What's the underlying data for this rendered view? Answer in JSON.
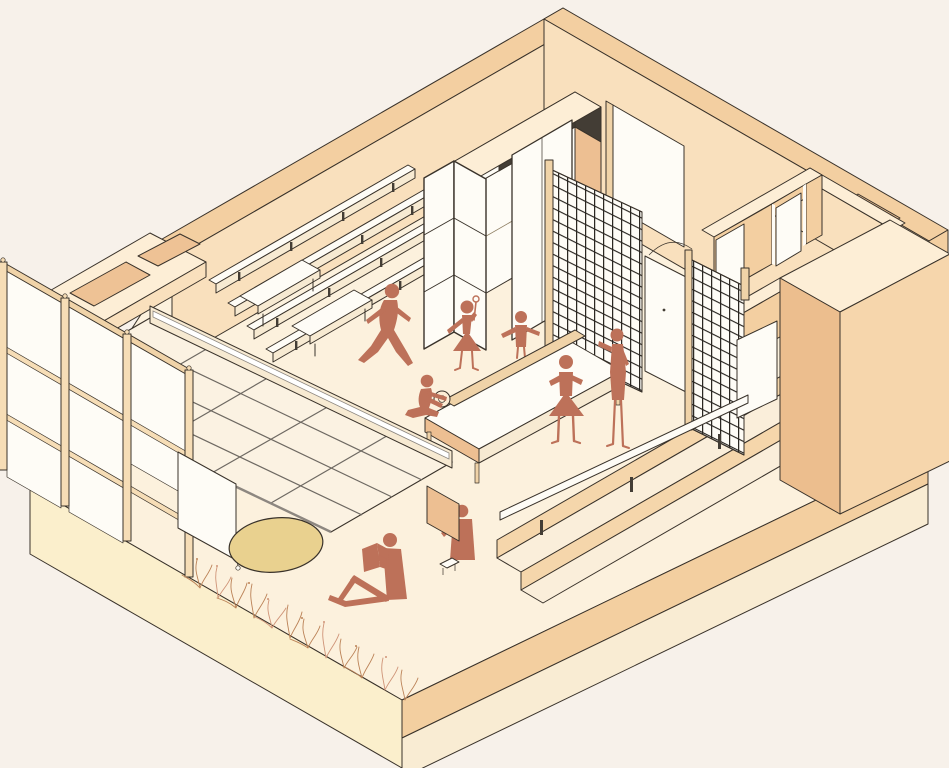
{
  "meta": {
    "image_type": "axonometric cutaway illustration",
    "subject": "open-plan interior (library / community room) with skylight, tiered wall shelving, wire-mesh partitions, long reading table and human silhouettes",
    "figure_count": 8
  },
  "palette": {
    "bg": "#f7f1ea",
    "line": "#39322a",
    "wall-band": "#f3cfa1",
    "wall-face": "#f9e0bd",
    "wall-top": "#fdeed6",
    "cavity-inner": "#eec295",
    "panel-white": "#fefcf6",
    "panel-peach": "#edbf92",
    "glass": "#fbf2e2",
    "floor": "#fcf1dd",
    "slab": "#f3cfa0",
    "plinth-left": "#fbefcc",
    "plinth-right": "#f9ecd3",
    "block-shadow": "#ecbe8e",
    "block-front": "#f6d6ac",
    "wood": "#f0d3a8",
    "wood-light": "#f6ddb6",
    "grille-dark": "#433d35",
    "grid-line": "#26221d",
    "mullion": "#6e6962",
    "track": "#ffffff",
    "riser": "#f5d6ab",
    "tread": "#faeeda",
    "apron": "#f7ead2",
    "figure": "#bd7159",
    "rug": "#e9d18f",
    "plant": "#bb8257",
    "plant-alt": "#cf9478",
    "frame": "#8c7c60"
  },
  "scene": {
    "shell": [
      "back-left wall",
      "back-right wall",
      "cavity-wall junction",
      "curtain-wall facade",
      "floor plate on plinth",
      "pass-through notch",
      "freestanding wall block",
      "alcove walls with doorway"
    ],
    "fixtures": [
      "tiered wall shelves (4 rows)",
      "storage cabinets with dark louvre clerestory",
      "folding screen",
      "sliding white panel",
      "white wall door",
      "wire grid partition A",
      "wire grid partition B",
      "sliding door between grids",
      "sloped skylight glazing with beam track",
      "roller screen",
      "tiered seating steps",
      "long bench plank",
      "long table with unrolled scroll",
      "two low benches",
      "side desk panel",
      "small stool",
      "oval rug",
      "planting bed"
    ],
    "figures": [
      {
        "pose": "walking"
      },
      {
        "pose": "dancing with ball-top wand"
      },
      {
        "pose": "arms outstretched"
      },
      {
        "pose": "kneeling at table end"
      },
      {
        "pose": "standing hands on hips"
      },
      {
        "pose": "standing reaching toward grid"
      },
      {
        "pose": "seated on floor reading a book"
      },
      {
        "pose": "seated behind low desk panel"
      }
    ]
  }
}
